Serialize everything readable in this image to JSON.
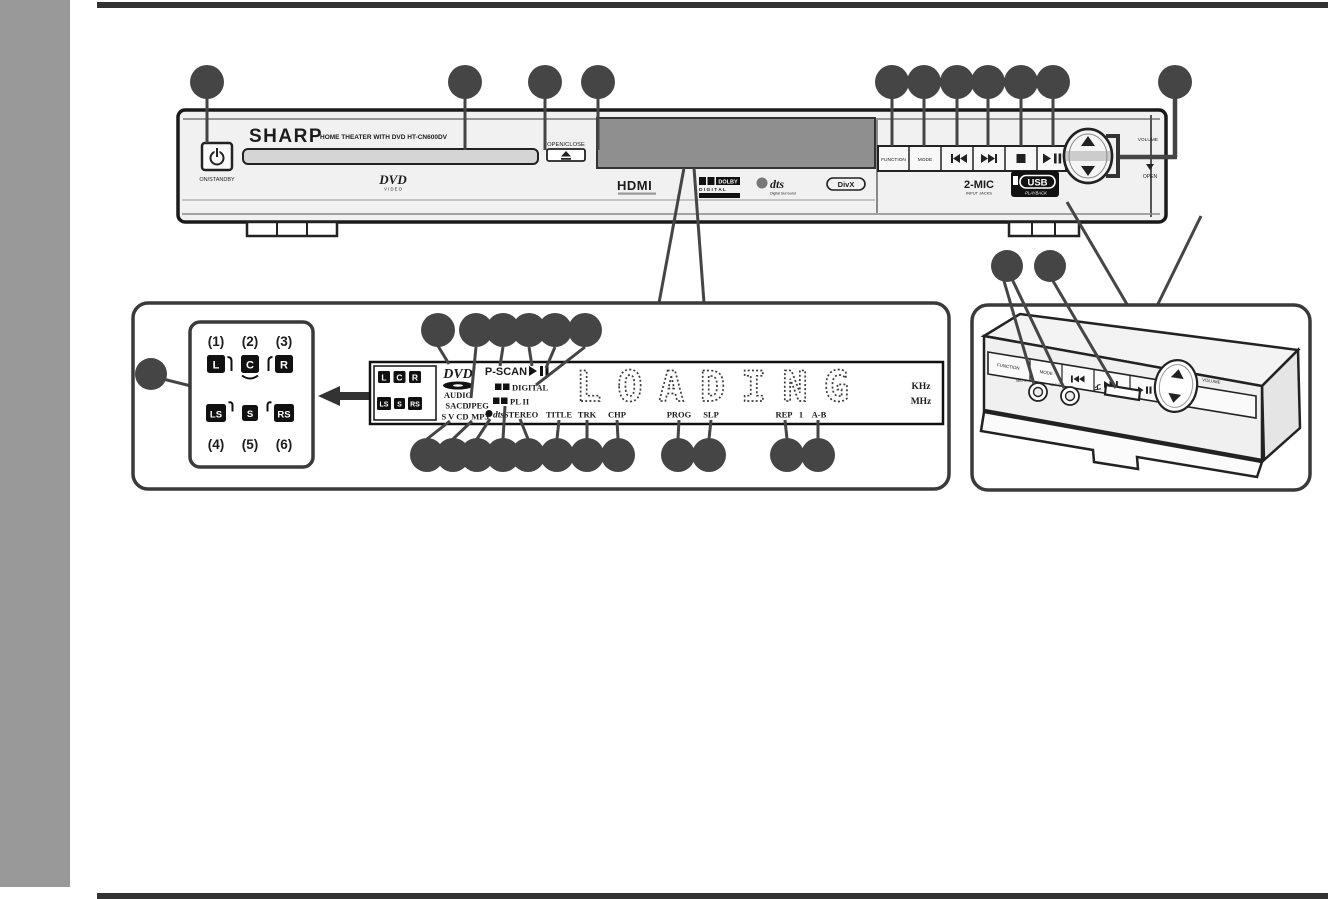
{
  "figure": {
    "front_panel": {
      "brand": "SHARP",
      "model_text": "HOME THEATER WITH DVD HT-CN600DV",
      "power_label": "ON/STANDBY",
      "open_close_label": "OPEN/CLOSE",
      "dvd_video_logo": "DVD",
      "dvd_video_logo_sub": "V I D E O",
      "hdmi_logo": "HDMI",
      "dolby_word": "DOLBY",
      "dolby_digital_word": "D I G I T A L",
      "dts_word": "dts",
      "dts_sub": "Digital Surround",
      "divx_word": "DivX",
      "function_button": "FUNCTION",
      "mode_button": "MODE",
      "volume_label": "VOLUME",
      "open_label": "OPEN",
      "mic_label": "2-MIC",
      "mic_sub": "INPUT JACKS",
      "usb_word": "USB",
      "usb_sub": "PLAYBACK"
    },
    "speaker_detail": {
      "numbers_top": [
        "(1)",
        "(2)",
        "(3)"
      ],
      "numbers_bottom": [
        "(4)",
        "(5)",
        "(6)"
      ],
      "channels_top": [
        "L",
        "C",
        "R"
      ],
      "channels_bottom": [
        "LS",
        "S",
        "RS"
      ]
    },
    "display_detail": {
      "channels_top": [
        "L",
        "C",
        "R"
      ],
      "channels_bottom": [
        "LS",
        "S",
        "RS"
      ],
      "dvd_logo": "DVD",
      "audio": "AUDIO",
      "sacd": "SACD",
      "svcd": "S V CD",
      "jpeg": "JPEG",
      "mp3": "MP3",
      "pscan": "P-SCAN",
      "digital": "DIGITAL",
      "pl2": "PL II",
      "dts": "dts",
      "stereo": "STEREO",
      "title": "TITLE",
      "trk": "TRK",
      "chp": "CHP",
      "prog": "PROG",
      "slp": "SLP",
      "rep": "REP",
      "one": "1",
      "a_b": "A-B",
      "loading": "LOADING",
      "khz": "KHz",
      "mhz": "MHz"
    },
    "side_view": {
      "function_button": "FUNCTION",
      "mode_button": "MODE",
      "volume_label": "VOLUME",
      "mic1_label": "MIC 1",
      "mic2_label": "MIC 2"
    }
  }
}
